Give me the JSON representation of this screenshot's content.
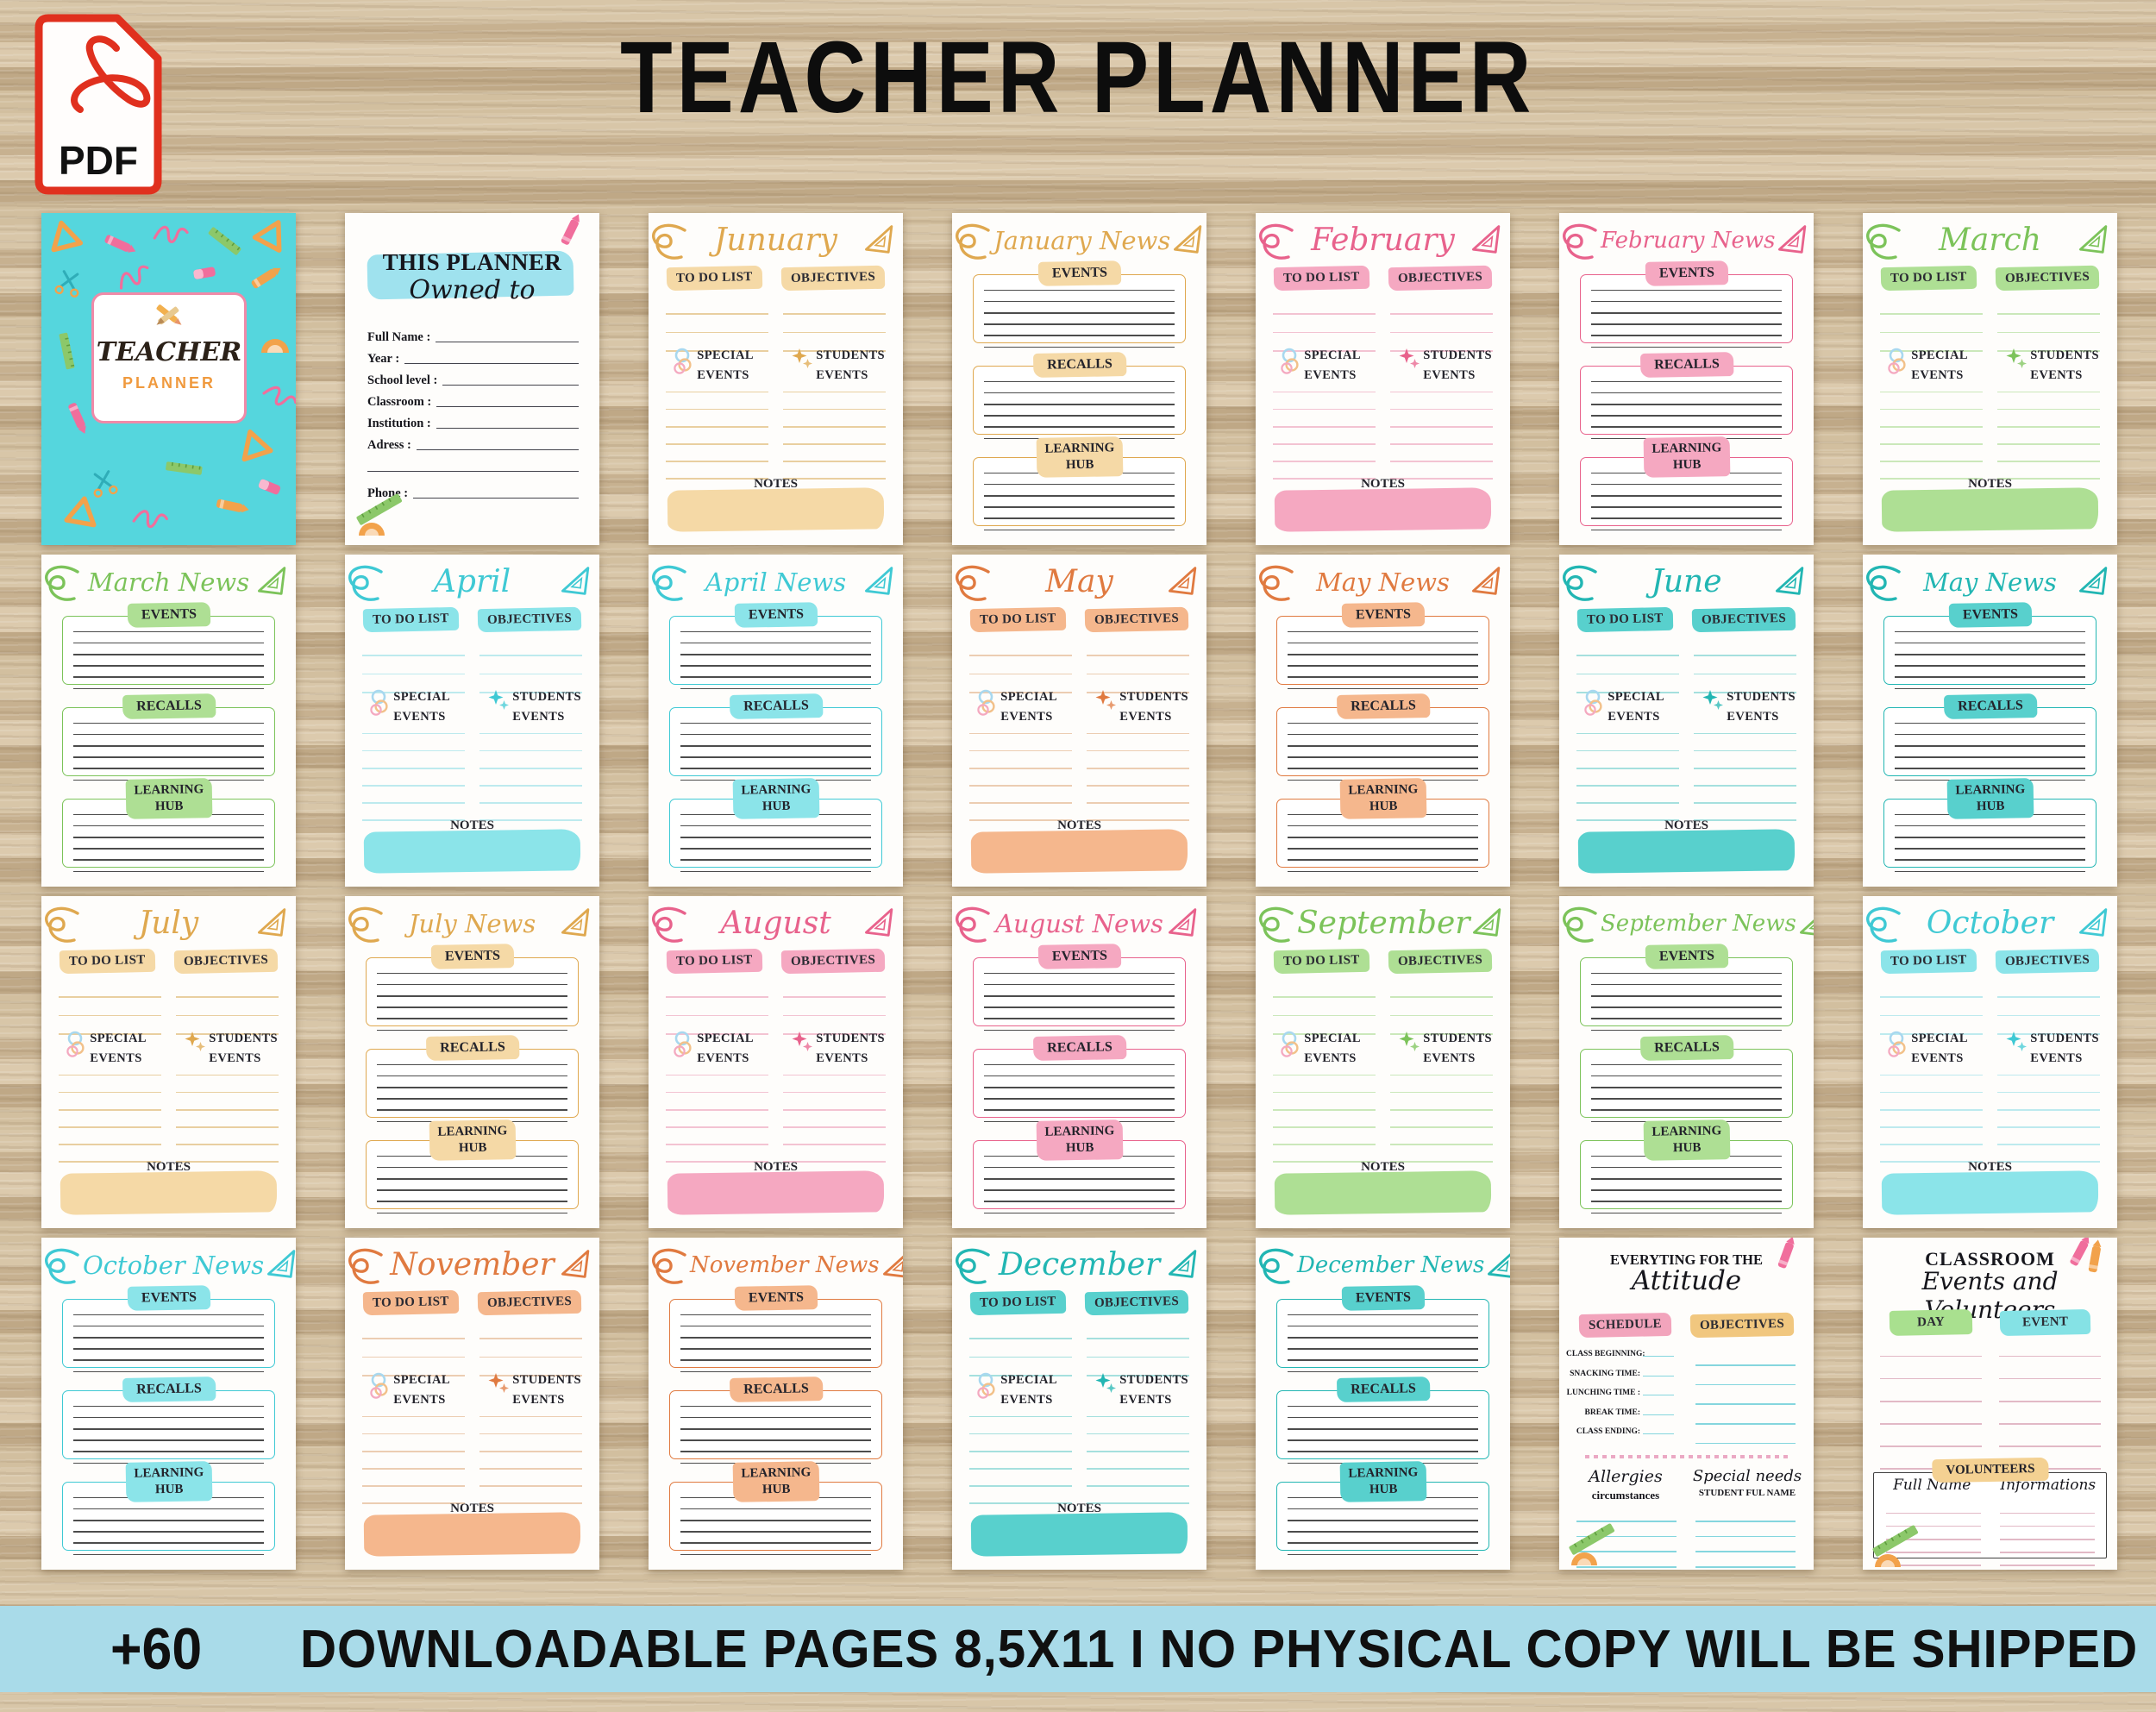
{
  "page": {
    "title": "TEACHER PLANNER",
    "pdf_badge": "PDF",
    "banner": {
      "count": "+60",
      "text": "DOWNLOADABLE PAGES 8,5X11 I NO PHYSICAL COPY WILL BE SHIPPED"
    }
  },
  "labels": {
    "todo": "TO DO LIST",
    "objectives": "OBJECTIVES",
    "special": "SPECIAL EVENTS",
    "students": "STUDENTS EVENTS",
    "notes": "NOTES",
    "events": "EVENTS",
    "recalls": "RECALLS",
    "learning_hub": "LEARNING HUB"
  },
  "cover": {
    "line1": "TEACHER",
    "line2": "PLANNER"
  },
  "owner": {
    "heading1": "THIS PLANNER",
    "heading2": "Owned to",
    "fields": [
      "Full Name :",
      "Year :",
      "School level :",
      "Classroom :",
      "Institution :",
      "Adress :",
      "",
      "Phone :"
    ]
  },
  "attitude": {
    "heading1": "EVERYTING FOR THE",
    "heading2": "Attitude",
    "schedule_label": "SCHEDULE",
    "objectives_label": "OBJECTIVES",
    "schedule_items": [
      "CLASS BEGINNING:",
      "SNACKING TIME:",
      "LUNCHING TIME :",
      "BREAK TIME:",
      "CLASS ENDING:"
    ],
    "allergies_line1": "Allergies",
    "allergies_line2": "circumstances",
    "special_line1": "Special needs",
    "special_line2": "STUDENT FUL NAME"
  },
  "classroom": {
    "heading1": "CLASSROOM",
    "heading2": "Events and Volunteers",
    "day_label": "DAY",
    "event_label": "EVENT",
    "volunteers_label": "VOLUNTEERS",
    "col1": "Full Name",
    "col2": "Informations"
  },
  "colors": {
    "background_wood": "#C9B395",
    "banner_bg": "#A9DBE9",
    "pdf_red": "#E0301E",
    "card_bg": "#FEFDFB",
    "news_line": "#4C4C4C",
    "cover_bg": "#55D6DD",
    "cover_box_border": "#F08AA8",
    "cover_planner_text": "#F09A3E",
    "owner_brush": "#9FE2EE",
    "palettes": {
      "gold": {
        "accent": "#DFA84F",
        "hi": "#F5D9A6",
        "line": "#E9CFA0"
      },
      "pink": {
        "accent": "#E8628C",
        "hi": "#F5A8C1",
        "line": "#F3C3D2"
      },
      "green": {
        "accent": "#7CC35A",
        "hi": "#AEDF94",
        "line": "#CBE8BA"
      },
      "teal": {
        "accent": "#3FC9D4",
        "hi": "#8BE4E9",
        "line": "#BDEAEE"
      },
      "orange": {
        "accent": "#E07A40",
        "hi": "#F5B78D",
        "line": "#ECCDB2"
      },
      "turquoise": {
        "accent": "#22B6B3",
        "hi": "#58D0CD",
        "line": "#A5E0DE"
      }
    },
    "attitude": {
      "schedule_hi": "#F2A4BC",
      "objectives_hi": "#F1C77F",
      "line": "#85D6DE",
      "dots": "#EBA9C4"
    },
    "classroom": {
      "day_hi": "#A9E08F",
      "event_hi": "#85E2E5",
      "volunteers_hi": "#F4D192",
      "line": "#E2B9C6",
      "box_border": "#3F3F3F"
    }
  },
  "pages": [
    {
      "type": "cover"
    },
    {
      "type": "owner"
    },
    {
      "type": "month",
      "title": "Junuary",
      "palette": "gold"
    },
    {
      "type": "news",
      "title": "January News",
      "palette": "gold"
    },
    {
      "type": "month",
      "title": "February",
      "palette": "pink"
    },
    {
      "type": "news",
      "title": "February News",
      "palette": "pink"
    },
    {
      "type": "month",
      "title": "March",
      "palette": "green"
    },
    {
      "type": "news",
      "title": "March News",
      "palette": "green"
    },
    {
      "type": "month",
      "title": "April",
      "palette": "teal"
    },
    {
      "type": "news",
      "title": "April News",
      "palette": "teal"
    },
    {
      "type": "month",
      "title": "May",
      "palette": "orange"
    },
    {
      "type": "news",
      "title": "May News",
      "palette": "orange"
    },
    {
      "type": "month",
      "title": "June",
      "palette": "turquoise"
    },
    {
      "type": "news",
      "title": "May News",
      "palette": "turquoise"
    },
    {
      "type": "month",
      "title": "July",
      "palette": "gold"
    },
    {
      "type": "news",
      "title": "July News",
      "palette": "gold"
    },
    {
      "type": "month",
      "title": "August",
      "palette": "pink"
    },
    {
      "type": "news",
      "title": "August News",
      "palette": "pink"
    },
    {
      "type": "month",
      "title": "September",
      "palette": "green"
    },
    {
      "type": "news",
      "title": "September News",
      "palette": "green"
    },
    {
      "type": "month",
      "title": "October",
      "palette": "teal"
    },
    {
      "type": "news",
      "title": "October News",
      "palette": "teal"
    },
    {
      "type": "month",
      "title": "November",
      "palette": "orange"
    },
    {
      "type": "news",
      "title": "November News",
      "palette": "orange"
    },
    {
      "type": "month",
      "title": "December",
      "palette": "turquoise"
    },
    {
      "type": "news",
      "title": "December News",
      "palette": "turquoise"
    },
    {
      "type": "attitude"
    },
    {
      "type": "classroom"
    }
  ]
}
